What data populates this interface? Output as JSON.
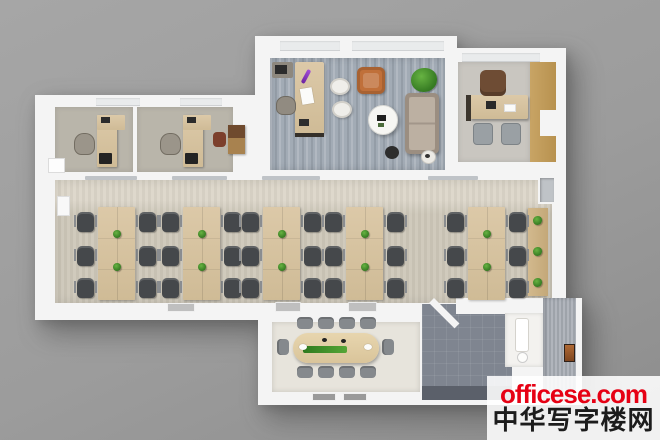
{
  "image_type": "3d-office-floor-plan-top-view-render",
  "watermark": {
    "site": "officese.com",
    "name": "中华写字楼网"
  },
  "palette": {
    "background": "#9c9c9c",
    "background_hi": "#a6a6a6",
    "background_lo": "#8d8d8d",
    "wall": "#f4f4f4",
    "window_slot": "#e9ebec",
    "glass": "#bfc3c7",
    "carpet_open": "#cdc7b9",
    "carpet_open_light": "#dcd6c9",
    "carpet_exec": "#a2abb5",
    "carpet_office": "#b9b5aa",
    "carpet_right_office": "#c9c6c0",
    "meeting_floor": "#e7e4dc",
    "corridor_tile": "#7f8590",
    "corridor_dark": "#5b606a",
    "bath_floor": "#f3f2ef",
    "wall_gray": "#a8adb5",
    "wood_desk": "#dcc9a8",
    "wood_desk_dark": "#cfbb96",
    "wood_counter": "#d2b98e",
    "wood_panel": "#c8a465",
    "chair_dark": "#45484b",
    "chair_arm": "#8a8d90",
    "chair_gray": "#85898d",
    "chair_orange": "#c0703a",
    "sofa": "#ad9f90",
    "plant_green": "#357a22",
    "plant_light": "#67b342",
    "watermark_red": "#e60114",
    "watermark_black": "#1c1c1c",
    "watermark_bg": "rgba(255,255,255,0.88)"
  }
}
